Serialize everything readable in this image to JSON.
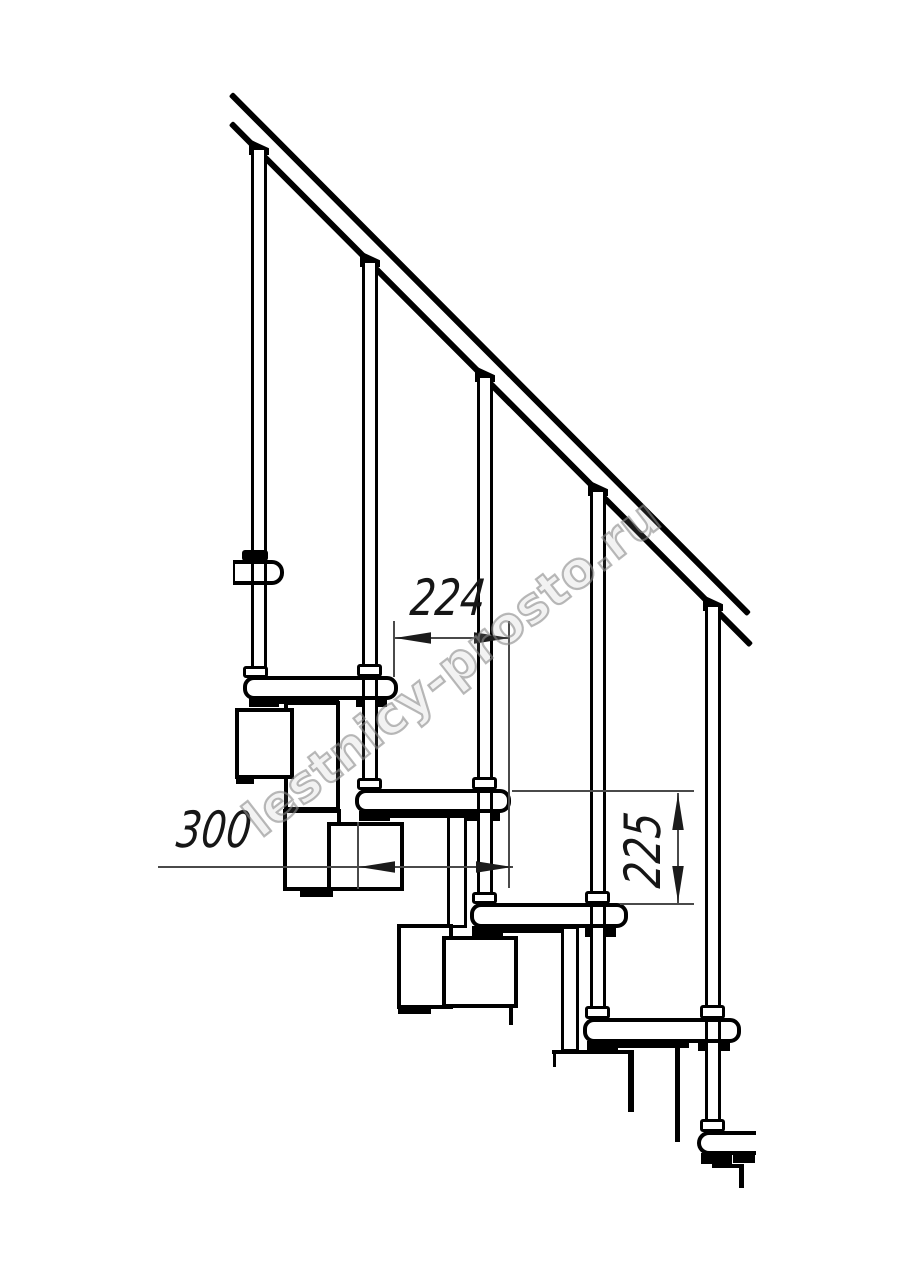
{
  "drawing": {
    "watermark": {
      "text": "lestnicy-prosto.ru"
    },
    "dimensions": {
      "run": {
        "value": "224"
      },
      "pitch": {
        "value": "300"
      },
      "rise": {
        "value": "225"
      }
    },
    "colors": {
      "ink": "#000000",
      "dim_line": "#4a4a4a",
      "background": "#ffffff",
      "watermark_stroke": "#8a8a8a"
    },
    "structure": {
      "treads_visible": 6,
      "balusters_visible": 5
    }
  }
}
